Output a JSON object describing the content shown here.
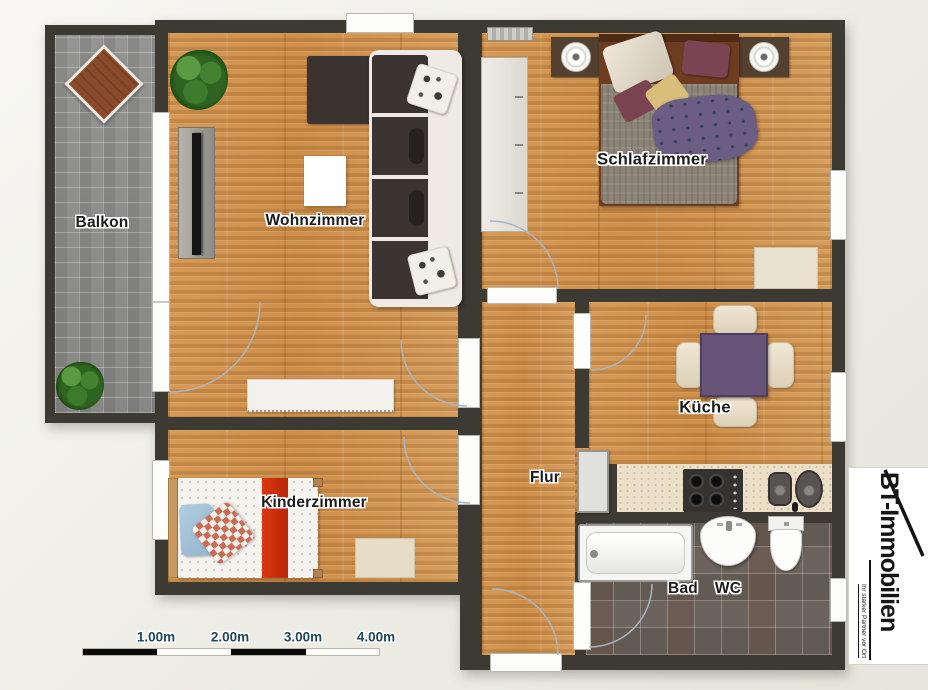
{
  "plan": {
    "wall_color": "#3d3a33",
    "wood_color": "#d2944f",
    "paver_color": "#8e8e8c",
    "tile_color": "#6b635c",
    "counter_color": "#ecdfc8",
    "accent_red": "#cf2a10",
    "table_purple": "#675478",
    "door_arc_color": "#a9b6c2",
    "rooms": [
      {
        "id": "balkon",
        "label": "Balkon"
      },
      {
        "id": "wohnzimmer",
        "label": "Wohnzimmer"
      },
      {
        "id": "schlafzimmer",
        "label": "Schlafzimmer"
      },
      {
        "id": "kueche",
        "label": "Küche"
      },
      {
        "id": "flur",
        "label": "Flur"
      },
      {
        "id": "kinderzimmer",
        "label": "Kinderzimmer"
      },
      {
        "id": "bad",
        "label": "Bad"
      },
      {
        "id": "wc",
        "label": "WC"
      }
    ],
    "furniture": [
      {
        "room": "balkon",
        "item": "lounge-chair"
      },
      {
        "room": "balkon",
        "item": "plant"
      },
      {
        "room": "wohnzimmer",
        "item": "plant"
      },
      {
        "room": "wohnzimmer",
        "item": "tv-board"
      },
      {
        "room": "wohnzimmer",
        "item": "coffee-table"
      },
      {
        "room": "wohnzimmer",
        "item": "corner-sofa"
      },
      {
        "room": "wohnzimmer",
        "item": "sideboard"
      },
      {
        "room": "schlafzimmer",
        "item": "radiator"
      },
      {
        "room": "schlafzimmer",
        "item": "wardrobe"
      },
      {
        "room": "schlafzimmer",
        "item": "double-bed"
      },
      {
        "room": "schlafzimmer",
        "item": "nightstand-left"
      },
      {
        "room": "schlafzimmer",
        "item": "nightstand-right"
      },
      {
        "room": "schlafzimmer",
        "item": "rug"
      },
      {
        "room": "kueche",
        "item": "dining-table"
      },
      {
        "room": "kueche",
        "item": "chairs"
      },
      {
        "room": "kueche",
        "item": "countertop"
      },
      {
        "room": "kueche",
        "item": "stove"
      },
      {
        "room": "kueche",
        "item": "sink"
      },
      {
        "room": "flur",
        "item": "cabinet"
      },
      {
        "room": "kinderzimmer",
        "item": "single-bed"
      },
      {
        "room": "kinderzimmer",
        "item": "rug"
      },
      {
        "room": "bad",
        "item": "bathtub"
      },
      {
        "room": "bad",
        "item": "washbasin"
      },
      {
        "room": "bad",
        "item": "toilet"
      }
    ]
  },
  "scale_bar": {
    "labels": [
      "1.00m",
      "2.00m",
      "3.00m",
      "4.00m"
    ],
    "label_color": "#1c4a5a"
  },
  "logo": {
    "title": "BT-Immobilien",
    "tagline": "Ihr starker Partner vor Ort"
  }
}
